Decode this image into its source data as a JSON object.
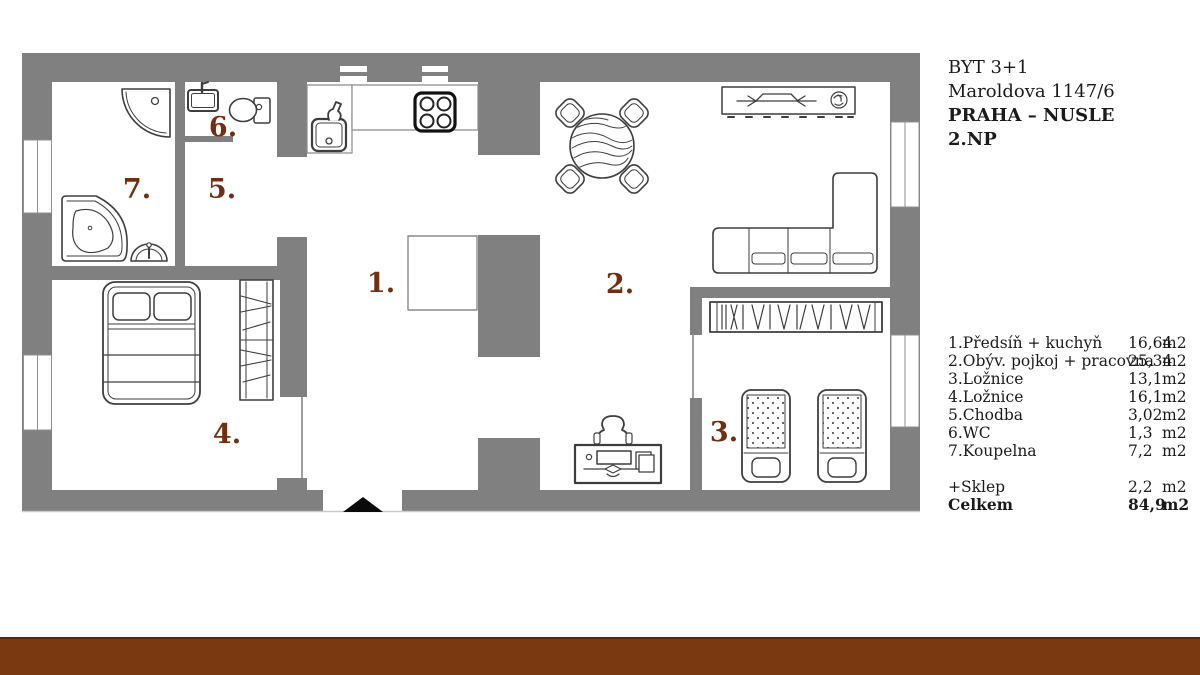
{
  "title_block": {
    "line1": "BYT 3+1",
    "line2": "Maroldova 1147/6",
    "line3": "PRAHA – NUSLE",
    "line4": "2.NP"
  },
  "legend": {
    "rows": [
      {
        "name": "1.Předsíň + kuchyň",
        "value": "16,64",
        "unit": "m2"
      },
      {
        "name": "2.Obýv. pojkoj + pracovna",
        "value": "25,34",
        "unit": "m2"
      },
      {
        "name": "3.Ložnice",
        "value": "13,1",
        "unit": "m2"
      },
      {
        "name": "4.Ložnice",
        "value": "16,1",
        "unit": "m2"
      },
      {
        "name": "5.Chodba",
        "value": "3,02",
        "unit": "m2"
      },
      {
        "name": "6.WC",
        "value": "1,3",
        "unit": "m2"
      },
      {
        "name": "7.Koupelna",
        "value": "7,2",
        "unit": "m2"
      }
    ],
    "extra_row": {
      "name": "+Sklep",
      "value": "2,2",
      "unit": "m2"
    },
    "total_row": {
      "name": "Celkem",
      "value": "84,9",
      "unit": "m2"
    }
  },
  "floor_plan": {
    "room_labels": [
      {
        "room": "predsin-kuchyn",
        "label": "1."
      },
      {
        "room": "obyvaci-pokoj",
        "label": "2."
      },
      {
        "room": "loznice-3",
        "label": "3."
      },
      {
        "room": "loznice-4",
        "label": "4."
      },
      {
        "room": "chodba",
        "label": "5."
      },
      {
        "room": "wc",
        "label": "6."
      },
      {
        "room": "koupelna",
        "label": "7."
      }
    ],
    "icons": [
      "shower-icon",
      "bathtub-icon",
      "washbasin-icon",
      "wc-sink-icon",
      "toilet-icon",
      "kitchen-sink-icon",
      "stove-icon",
      "dining-table-icon",
      "chair-icon",
      "sideboard-icon",
      "tv-icon",
      "plant-icon",
      "sofa-icon",
      "wardrobe-icon",
      "double-bed-icon",
      "single-bed-icon",
      "desk-icon",
      "desk-chair-icon",
      "entrance-arrow-icon",
      "window"
    ]
  },
  "colors": {
    "wall": "#808080",
    "furniture_line": "#3e3e3e",
    "room_number": "#722e0e",
    "entrance_marker": "#0a0a0a",
    "bottom_bar": "#7b3911"
  }
}
